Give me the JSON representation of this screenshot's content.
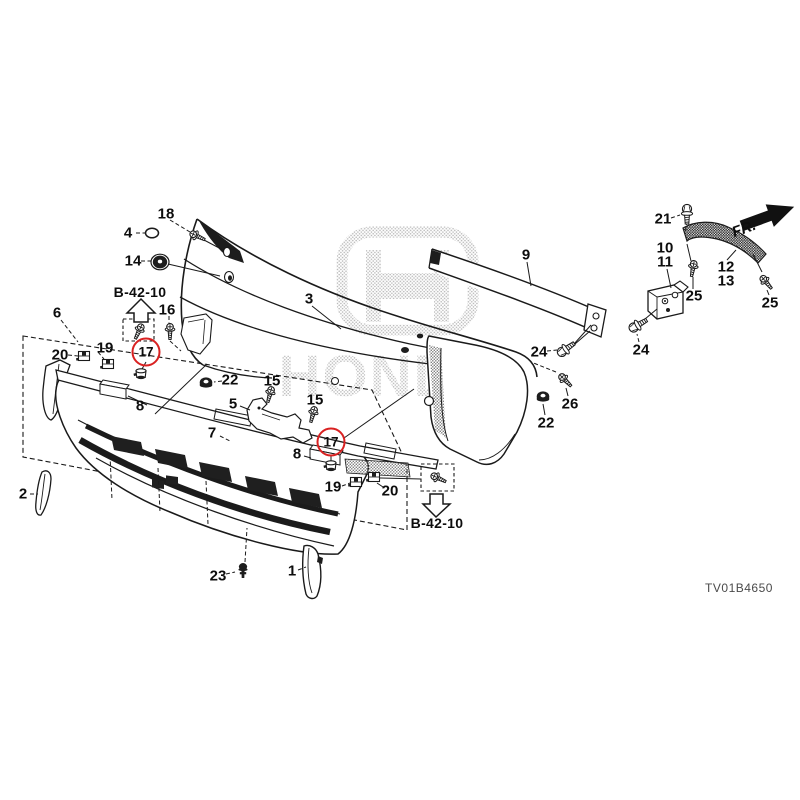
{
  "diagram": {
    "code": "TV01B4650",
    "direction_indicator": "FR.",
    "watermark_text": "HONDA",
    "highlight_color": "#d92121",
    "line_color": "#1a1a1a",
    "reference_links": [
      {
        "text": "B-42-10",
        "x": 140,
        "y": 292,
        "arrow": "up"
      },
      {
        "text": "B-42-10",
        "x": 437,
        "y": 523,
        "arrow": "down"
      }
    ],
    "part_labels": [
      {
        "num": "1",
        "x": 292,
        "y": 571,
        "circled": false
      },
      {
        "num": "2",
        "x": 23,
        "y": 494,
        "circled": false
      },
      {
        "num": "3",
        "x": 309,
        "y": 299,
        "circled": false
      },
      {
        "num": "4",
        "x": 128,
        "y": 233,
        "circled": false
      },
      {
        "num": "5",
        "x": 233,
        "y": 404,
        "circled": false
      },
      {
        "num": "6",
        "x": 57,
        "y": 313,
        "circled": false
      },
      {
        "num": "7",
        "x": 212,
        "y": 433,
        "circled": false
      },
      {
        "num": "8",
        "x": 140,
        "y": 406,
        "circled": false
      },
      {
        "num": "8",
        "x": 297,
        "y": 454,
        "circled": false
      },
      {
        "num": "9",
        "x": 526,
        "y": 255,
        "circled": false
      },
      {
        "num": "10",
        "x": 665,
        "y": 248,
        "circled": false
      },
      {
        "num": "11",
        "x": 665,
        "y": 262,
        "circled": false
      },
      {
        "num": "12",
        "x": 726,
        "y": 267,
        "circled": false
      },
      {
        "num": "13",
        "x": 726,
        "y": 281,
        "circled": false
      },
      {
        "num": "14",
        "x": 133,
        "y": 261,
        "circled": false
      },
      {
        "num": "15",
        "x": 272,
        "y": 381,
        "circled": false
      },
      {
        "num": "15",
        "x": 315,
        "y": 400,
        "circled": false
      },
      {
        "num": "16",
        "x": 167,
        "y": 310,
        "circled": false
      },
      {
        "num": "17",
        "x": 146,
        "y": 352,
        "circled": true
      },
      {
        "num": "17",
        "x": 331,
        "y": 442,
        "circled": true
      },
      {
        "num": "18",
        "x": 166,
        "y": 214,
        "circled": false
      },
      {
        "num": "19",
        "x": 105,
        "y": 348,
        "circled": false
      },
      {
        "num": "19",
        "x": 333,
        "y": 487,
        "circled": false
      },
      {
        "num": "20",
        "x": 60,
        "y": 355,
        "circled": false
      },
      {
        "num": "20",
        "x": 390,
        "y": 491,
        "circled": false
      },
      {
        "num": "21",
        "x": 663,
        "y": 219,
        "circled": false
      },
      {
        "num": "22",
        "x": 230,
        "y": 380,
        "circled": false
      },
      {
        "num": "22",
        "x": 546,
        "y": 423,
        "circled": false
      },
      {
        "num": "23",
        "x": 218,
        "y": 576,
        "circled": false
      },
      {
        "num": "24",
        "x": 539,
        "y": 352,
        "circled": false
      },
      {
        "num": "24",
        "x": 641,
        "y": 350,
        "circled": false
      },
      {
        "num": "25",
        "x": 694,
        "y": 296,
        "circled": false
      },
      {
        "num": "25",
        "x": 770,
        "y": 303,
        "circled": false
      },
      {
        "num": "26",
        "x": 570,
        "y": 404,
        "circled": false
      }
    ],
    "fastener_icons": [
      {
        "type": "ring",
        "x": 152,
        "y": 233,
        "rot": 0
      },
      {
        "type": "screw",
        "x": 197,
        "y": 236,
        "rot": -65
      },
      {
        "type": "flange-nut",
        "x": 160,
        "y": 262,
        "rot": 0
      },
      {
        "type": "screw",
        "x": 170,
        "y": 331,
        "rot": 0
      },
      {
        "type": "screw",
        "x": 139,
        "y": 331,
        "rot": 25
      },
      {
        "type": "grommet",
        "x": 141,
        "y": 374,
        "rot": 0
      },
      {
        "type": "grommet",
        "x": 331,
        "y": 466,
        "rot": 0
      },
      {
        "type": "clip",
        "x": 84,
        "y": 356,
        "rot": 0
      },
      {
        "type": "clip",
        "x": 108,
        "y": 364,
        "rot": 0
      },
      {
        "type": "clip",
        "x": 356,
        "y": 482,
        "rot": 0
      },
      {
        "type": "clip",
        "x": 374,
        "y": 477,
        "rot": 0
      },
      {
        "type": "nut",
        "x": 206,
        "y": 382,
        "rot": 0
      },
      {
        "type": "nut",
        "x": 543,
        "y": 396,
        "rot": 0
      },
      {
        "type": "screw",
        "x": 270,
        "y": 394,
        "rot": 15
      },
      {
        "type": "screw",
        "x": 313,
        "y": 414,
        "rot": 15
      },
      {
        "type": "rivet",
        "x": 243,
        "y": 571,
        "rot": 0
      },
      {
        "type": "bolt",
        "x": 566,
        "y": 349,
        "rot": -35
      },
      {
        "type": "bolt",
        "x": 638,
        "y": 325,
        "rot": -30
      },
      {
        "type": "bolt",
        "x": 687,
        "y": 214,
        "rot": 90
      },
      {
        "type": "screw",
        "x": 693,
        "y": 268,
        "rot": 10
      },
      {
        "type": "screw",
        "x": 766,
        "y": 282,
        "rot": -40
      },
      {
        "type": "screw",
        "x": 565,
        "y": 380,
        "rot": -45
      },
      {
        "type": "screw",
        "x": 438,
        "y": 478,
        "rot": -65
      }
    ]
  }
}
